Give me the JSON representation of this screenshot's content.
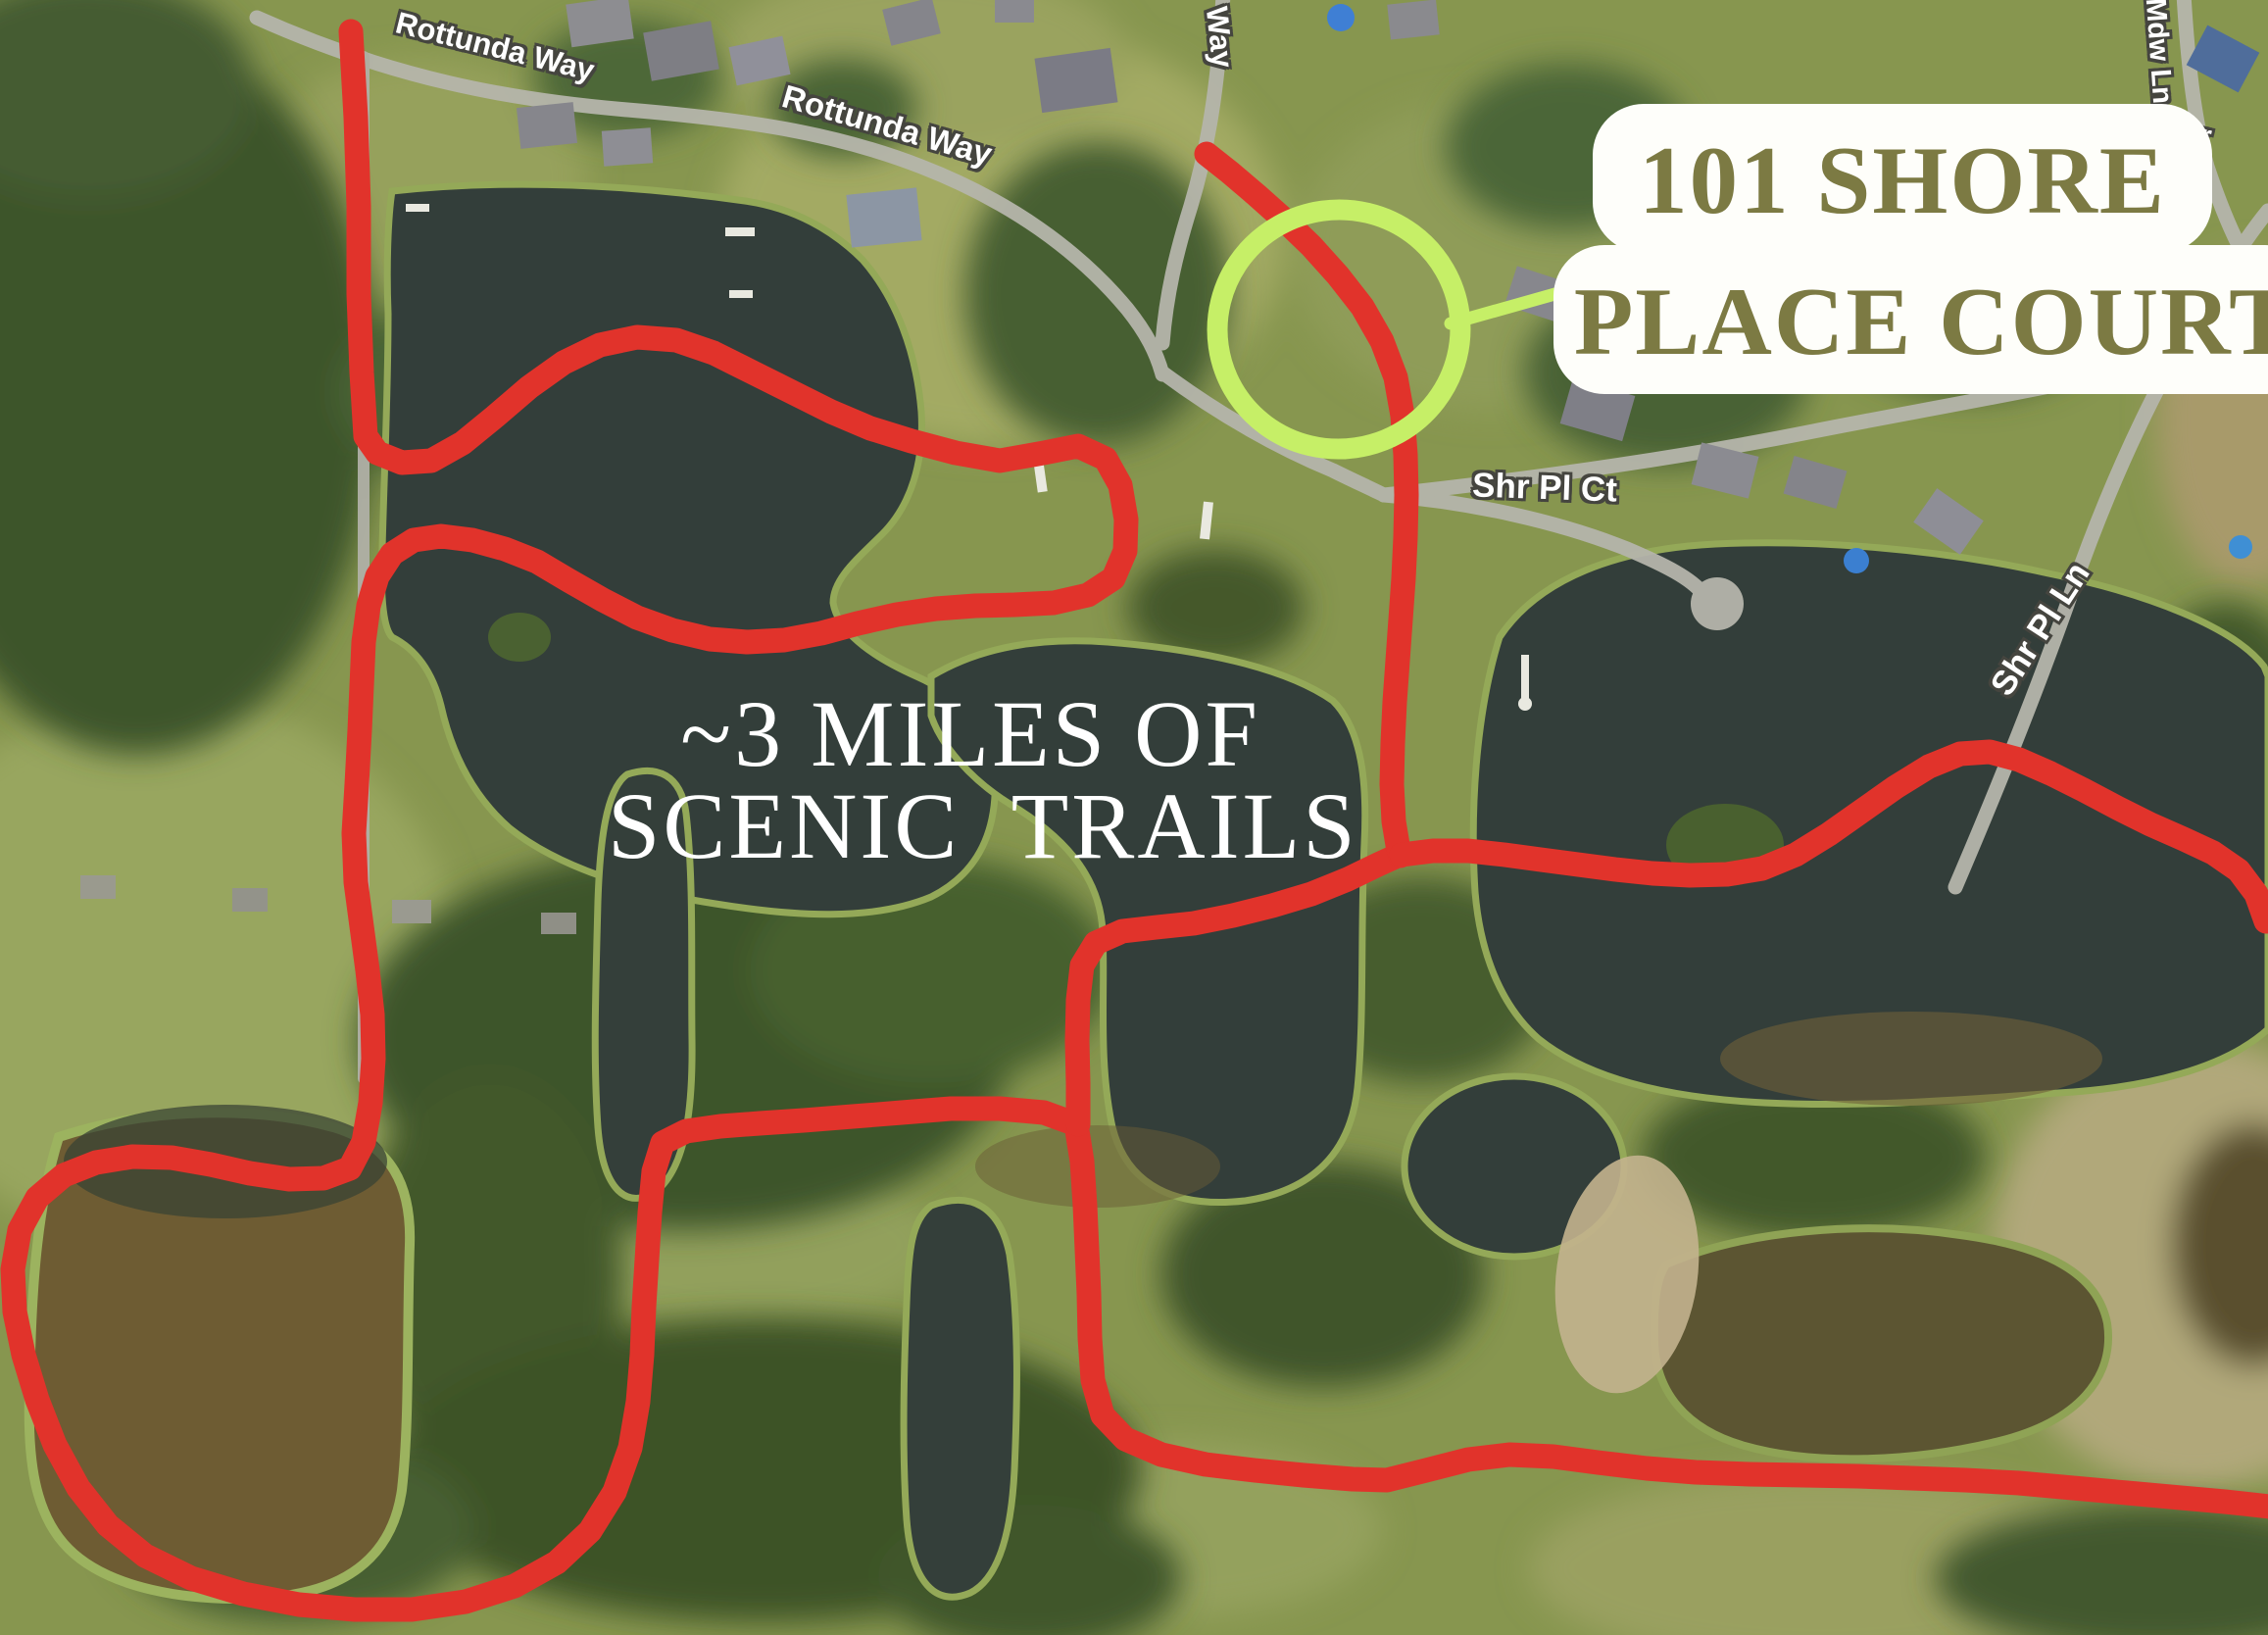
{
  "callout": {
    "line1": "101 SHORE",
    "line2": "PLACE COURT"
  },
  "trail_note": {
    "line1": "~3 MILES OF",
    "line2": "SCENIC  TRAILS"
  },
  "streets": {
    "rottunda_way_upper": "Rottunda Way",
    "rottunda_way_lower": "Rottunda Way",
    "way_partial": "Way",
    "shr_pl_ct": "Shr Pl Ct",
    "shr_pl_ln": "Shr Pl Ln",
    "mdw_ln": "Mdw Ln",
    "partial_r": "r"
  },
  "colors": {
    "trail_red": "#e1332b",
    "highlight_green": "#c6ef67",
    "address_text": "#7c7a43",
    "callout_bg": "#fefefa",
    "street_label_text": "#ffffff",
    "street_label_outline": "#45453f",
    "note_text": "#ffffff",
    "water": "#333e3a",
    "shoreline": "#94a958"
  }
}
